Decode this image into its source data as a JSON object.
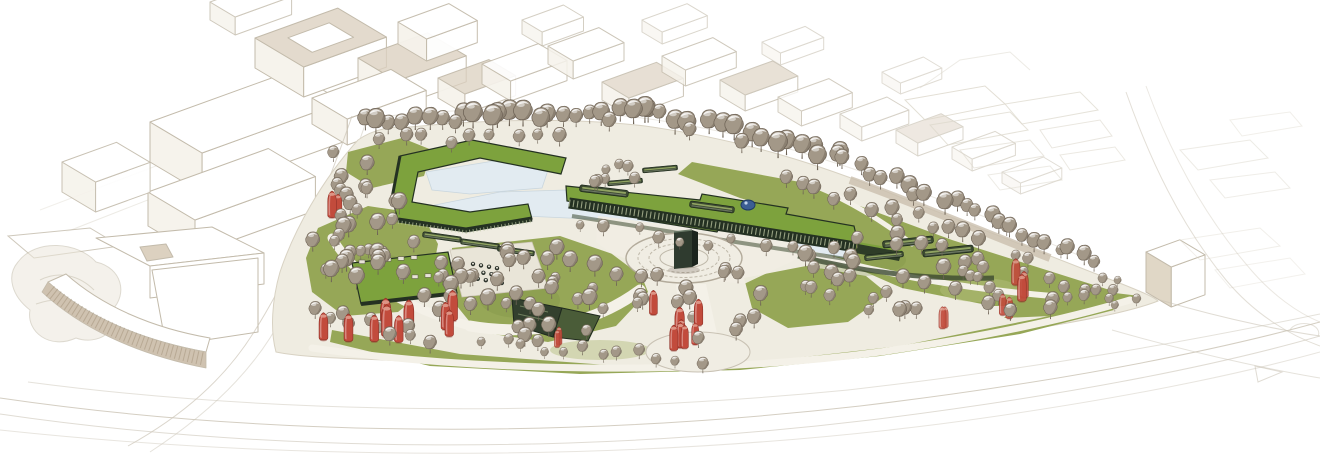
{
  "meta": {
    "title": "Aerial masterplan rendering of a linear park",
    "description": "Hand-rendered axonometric architectural masterplan: an elongated wedge-shaped park with green-roof buildings, a water basin, a circular monument plaza with a dark monolith, dense taupe tree canopy with red accent trees, a cafe pavilion with terrace seating, surrounded by white line-drawn city context blocks and faint sweeping roads.",
    "visible_text": []
  },
  "colors": {
    "background": "#ffffff",
    "context_line": "#c3bbab",
    "context_line_faint": "#dcd7cb",
    "context_shade": "#dcd1c0",
    "road_line": "#ccc5b7",
    "site_ground": "#efece1",
    "site_edge": "#d8d2c3",
    "path": "#f4f1e8",
    "plaza_fill": "#f0ede3",
    "plaza_ring": "#b3ab9b",
    "lawn": "#96a757",
    "lawn_light": "#b2bd79",
    "lawn_dark": "#7d9346",
    "roof_green": "#7da23d",
    "facade_dark": "#243122",
    "facade_mullion": "#bcc6a1",
    "water": "#e2ebf1",
    "tree_crown": "#a39888",
    "tree_shadow": "#6e6356",
    "tree_red": "#c24b3c",
    "tree_red_dark": "#8e2f26",
    "tree_red_light": "#e09c8d",
    "hedge_dark": "#3c4a31",
    "monument": "#2f3b2f",
    "skylight_blue": "#3c5e93",
    "terrace": "#e9e5d8",
    "stripe_tan": "#cfc2b0"
  },
  "scene": {
    "context_blocks": [
      [
        150,
        122,
        150,
        62,
        40,
        0,
        1,
        0
      ],
      [
        148,
        192,
        128,
        56,
        34,
        0,
        1,
        0
      ],
      [
        62,
        162,
        58,
        40,
        30,
        0,
        0.9,
        0
      ],
      [
        255,
        38,
        88,
        58,
        30,
        1,
        1,
        1
      ],
      [
        358,
        58,
        74,
        46,
        26,
        1,
        1,
        0
      ],
      [
        312,
        98,
        84,
        42,
        26,
        0,
        1,
        0
      ],
      [
        398,
        22,
        54,
        34,
        22,
        0,
        0.95,
        0
      ],
      [
        438,
        78,
        54,
        32,
        20,
        1,
        0.95,
        0
      ],
      [
        210,
        2,
        60,
        30,
        18,
        0,
        0.8,
        0
      ],
      [
        482,
        64,
        60,
        34,
        20,
        0,
        0.9,
        0
      ],
      [
        548,
        46,
        54,
        30,
        18,
        0,
        0.85,
        0
      ],
      [
        602,
        82,
        58,
        32,
        18,
        1,
        0.85,
        0
      ],
      [
        662,
        56,
        54,
        28,
        16,
        0,
        0.8,
        0
      ],
      [
        720,
        80,
        56,
        30,
        16,
        1,
        0.8,
        0
      ],
      [
        778,
        97,
        54,
        28,
        15,
        0,
        0.75,
        0
      ],
      [
        840,
        114,
        50,
        26,
        14,
        0,
        0.65,
        0
      ],
      [
        896,
        130,
        48,
        26,
        13,
        1,
        0.6,
        0
      ],
      [
        522,
        20,
        44,
        24,
        14,
        0,
        0.7,
        0
      ],
      [
        642,
        20,
        48,
        24,
        12,
        0,
        0.6,
        0
      ],
      [
        762,
        42,
        46,
        22,
        12,
        0,
        0.55,
        0
      ],
      [
        882,
        72,
        44,
        22,
        11,
        0,
        0.5,
        0
      ],
      [
        952,
        147,
        46,
        24,
        12,
        0,
        0.55,
        0
      ],
      [
        1002,
        172,
        44,
        22,
        11,
        0,
        0.5,
        0
      ],
      [
        1146,
        252,
        36,
        30,
        40,
        2,
        1,
        0
      ]
    ],
    "tree_bands": [
      [
        368,
        133,
        648,
        126,
        24,
        5,
        16,
        24,
        11
      ],
      [
        648,
        126,
        845,
        172,
        18,
        6,
        16,
        24,
        22
      ],
      [
        845,
        172,
        1012,
        240,
        15,
        6,
        14,
        22,
        33
      ],
      [
        1012,
        240,
        1096,
        268,
        8,
        5,
        12,
        18,
        44
      ],
      [
        382,
        152,
        560,
        146,
        9,
        6,
        12,
        17,
        55
      ],
      [
        584,
        236,
        840,
        262,
        11,
        8,
        10,
        15,
        66
      ],
      [
        318,
        322,
        428,
        350,
        10,
        6,
        12,
        18,
        77
      ],
      [
        484,
        352,
        700,
        368,
        12,
        6,
        10,
        15,
        88
      ],
      [
        790,
        192,
        980,
        250,
        13,
        8,
        12,
        18,
        99
      ]
    ],
    "tree_clusters": [
      [
        362,
        252,
        52,
        58,
        26,
        12,
        20,
        101
      ],
      [
        540,
        300,
        92,
        52,
        32,
        12,
        20,
        102
      ],
      [
        690,
        312,
        72,
        38,
        18,
        11,
        18,
        103
      ],
      [
        880,
        282,
        80,
        44,
        24,
        12,
        19,
        104
      ],
      [
        1022,
        292,
        78,
        33,
        22,
        11,
        17,
        105
      ],
      [
        345,
        192,
        26,
        36,
        9,
        12,
        18,
        106
      ],
      [
        1120,
        296,
        30,
        16,
        7,
        9,
        13,
        107
      ],
      [
        452,
        300,
        30,
        28,
        10,
        12,
        18,
        108
      ],
      [
        608,
        180,
        40,
        18,
        7,
        10,
        14,
        109
      ]
    ],
    "red_clusters": [
      [
        363,
        335,
        52,
        14,
        7,
        18,
        26,
        201,
        1
      ],
      [
        452,
        322,
        9,
        24,
        3,
        20,
        26,
        202,
        1
      ],
      [
        335,
        205,
        9,
        20,
        2,
        16,
        22,
        203,
        1
      ],
      [
        690,
        332,
        46,
        26,
        8,
        16,
        24,
        204,
        1
      ],
      [
        1022,
        302,
        34,
        22,
        5,
        16,
        22,
        205,
        0.9
      ],
      [
        948,
        322,
        14,
        10,
        2,
        14,
        18,
        206,
        0.8
      ],
      [
        560,
        345,
        10,
        8,
        2,
        12,
        16,
        207,
        0.9
      ]
    ],
    "strips": [
      [
        442,
        237,
        8,
        40
      ],
      [
        480,
        244,
        8,
        40
      ],
      [
        516,
        251,
        8,
        38
      ],
      [
        604,
        191,
        7,
        50
      ],
      [
        712,
        207,
        8,
        46
      ],
      [
        908,
        242,
        -6,
        52
      ],
      [
        948,
        251,
        -6,
        52
      ],
      [
        884,
        256,
        -6,
        40
      ],
      [
        660,
        169,
        -5,
        36
      ],
      [
        625,
        182,
        -5,
        36
      ]
    ],
    "furniture_grids": [
      {
        "ox": 473,
        "oy": 264,
        "cols": 4,
        "rows": 3,
        "ux": 8,
        "uy": 1.4,
        "vx": 2.4,
        "vy": 7.4,
        "kind": "table"
      },
      {
        "ox": 362,
        "oy": 262,
        "cols": 5,
        "rows": 1,
        "ux": 13,
        "uy": -1.1,
        "vx": 0,
        "vy": 0,
        "kind": "lounger"
      },
      {
        "ox": 402,
        "oy": 278,
        "cols": 3,
        "rows": 1,
        "ux": 13,
        "uy": -1.1,
        "vx": 0,
        "vy": 0,
        "kind": "lounger"
      }
    ]
  }
}
